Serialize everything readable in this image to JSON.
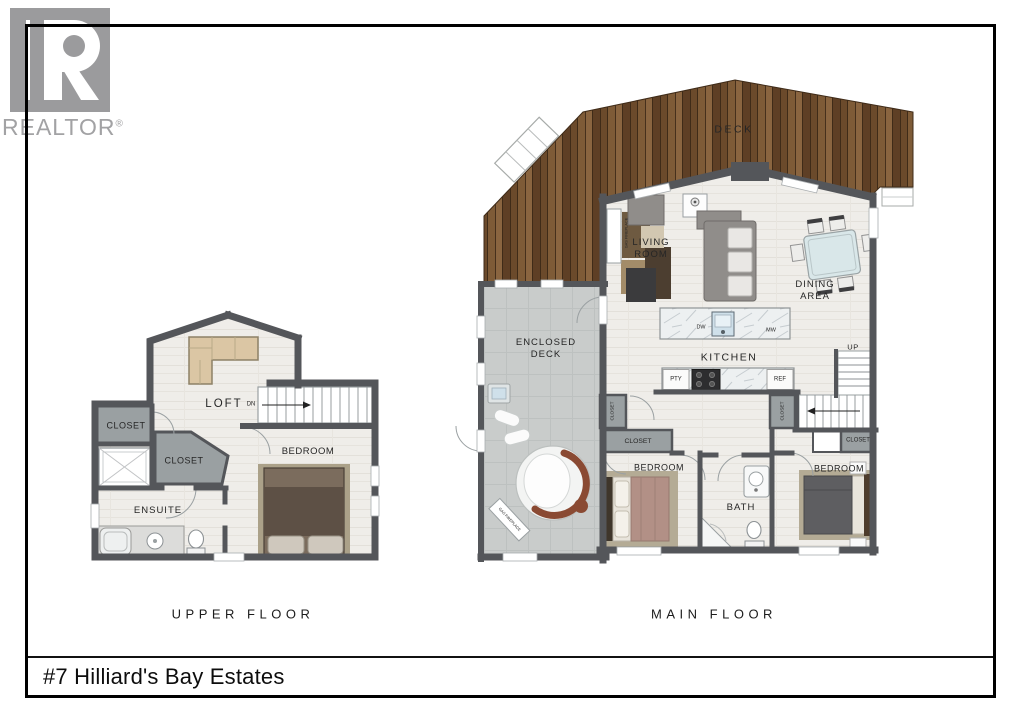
{
  "logo": {
    "brand": "REALTOR",
    "registered": "®"
  },
  "title_bar": {
    "address": "#7 Hilliard's Bay Estates"
  },
  "upper_floor": {
    "caption": "UPPER FLOOR",
    "labels": {
      "loft": "LOFT",
      "dn": "DN",
      "closet_top": "CLOSET",
      "closet_mid": "CLOSET",
      "ensuite": "ENSUITE",
      "bedroom": "BEDROOM"
    }
  },
  "main_floor": {
    "caption": "MAIN FLOOR",
    "labels": {
      "deck": "DECK",
      "living_room": "LIVING ROOM",
      "dining_area": "DINING AREA",
      "enclosed_deck": "ENCLOSED DECK",
      "kitchen": "KITCHEN",
      "dw": "DW",
      "mw": "MW",
      "pty": "PTY",
      "ref": "REF",
      "up": "UP",
      "bath": "BATH",
      "bedroom_left": "BEDROOM",
      "bedroom_right": "BEDROOM",
      "closet_hall_left": "CLOSET",
      "closet_hall_right": "CLOSET",
      "closet_left": "CLOSET",
      "closet_right": "CLOSET",
      "gas_fireplace_living": "GAS FIREPLACE",
      "gas_fireplace_deck": "GAS FIREPLACE"
    }
  },
  "palette": {
    "wall": "#54565a",
    "wood": "#75522f",
    "wood_dark": "#3f2b18",
    "floor": "#efede9",
    "enclosed_deck": "#c9cccb",
    "closet": "#9aa0a2",
    "sofa_tan": "#dbc6a4",
    "bed_brown": "#5d5045",
    "accent_rust": "#8a4a33",
    "logo_gray": "#9b9b9d"
  }
}
